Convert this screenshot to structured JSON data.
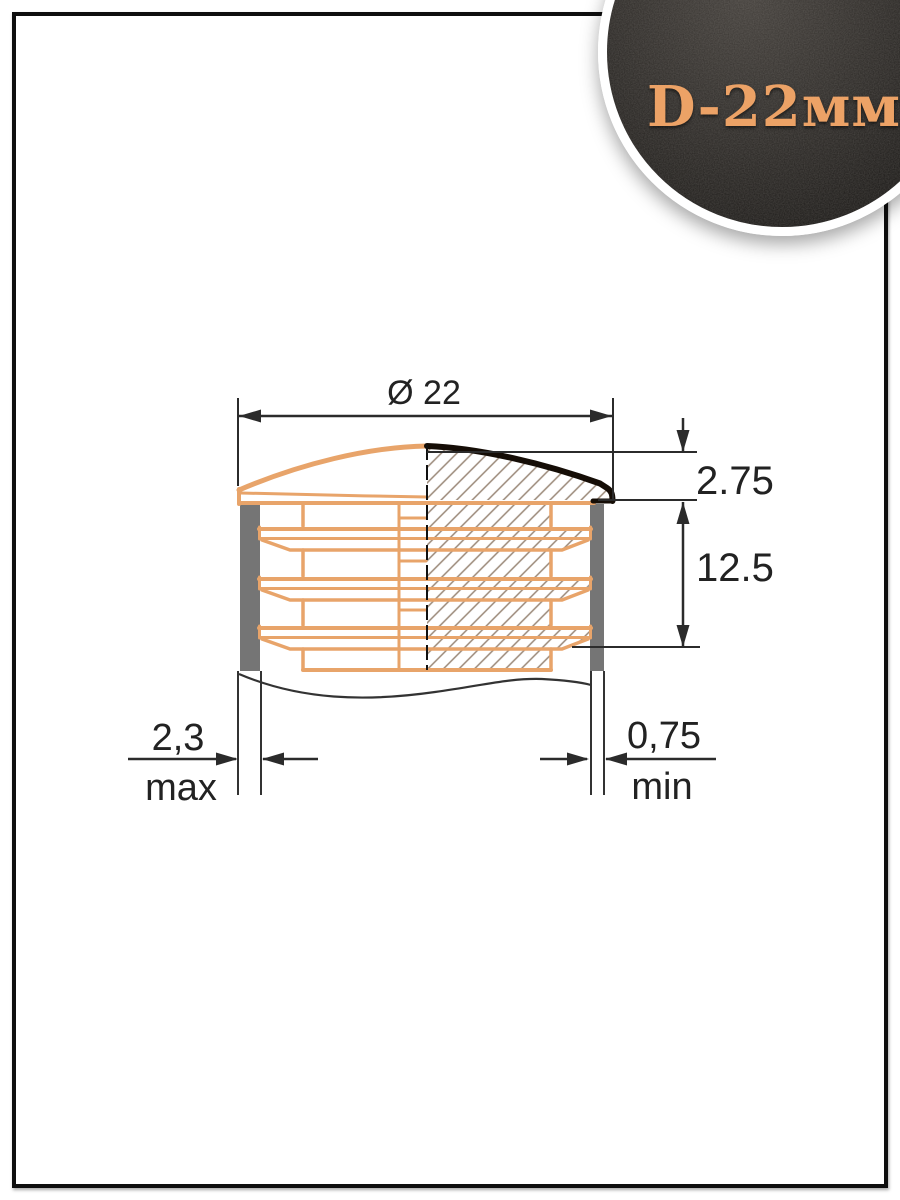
{
  "badge": {
    "label": "D-22мм",
    "text_color": "#ECA266"
  },
  "dims": {
    "diameter": "Ø 22",
    "lip_height": "2.75",
    "insert_depth": "12.5",
    "wall_thickness_max": "2,3",
    "wall_thickness_max_note": "max",
    "wall_thickness_min": "0,75",
    "wall_thickness_min_note": "min"
  },
  "colors": {
    "outline_orange": "#E8A46A",
    "tube_wall_gray": "#757575",
    "hatch_line": "#9a8878",
    "drawing_line": "#2b2b2b",
    "cap_top_black": "#150d06"
  }
}
